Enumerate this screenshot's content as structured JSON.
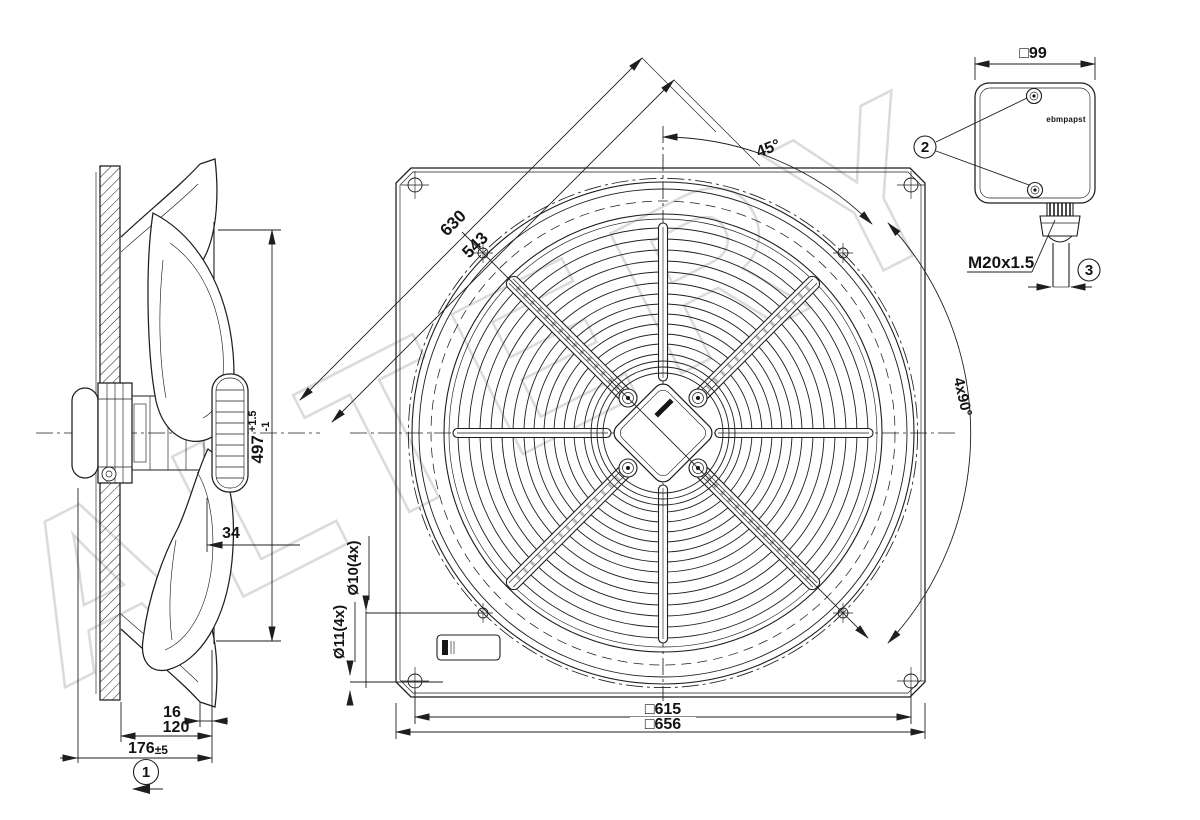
{
  "watermark": {
    "text": "ALTERY",
    "color": "#d5d5d5"
  },
  "colors": {
    "line": "#1e1e1e",
    "background": "#ffffff"
  },
  "front_view": {
    "dim_diag_outer": "630",
    "dim_diag_inner": "543",
    "angle_first": "45°",
    "angle_pattern": "4x90°",
    "holes_small": "Ø10(4x)",
    "holes_corner": "Ø11(4x)",
    "pitch_square": "□615",
    "plate_square": "□656"
  },
  "side_view": {
    "impeller_dia_main": "497",
    "impeller_dia_tol_plus": "+1.5",
    "impeller_dia_tol_minus": "-1",
    "dim_blade_offset": "34",
    "dim_guard_gap": "16",
    "dim_depth_plate": "120",
    "dim_depth_total_main": "176",
    "dim_depth_total_tol": "±5",
    "callout_airflow": "1"
  },
  "terminal_box": {
    "dim_square": "□99",
    "logo": "ebmpapst",
    "gland_thread": "M20x1.5",
    "callout_screws": "2",
    "callout_cable": "3"
  }
}
